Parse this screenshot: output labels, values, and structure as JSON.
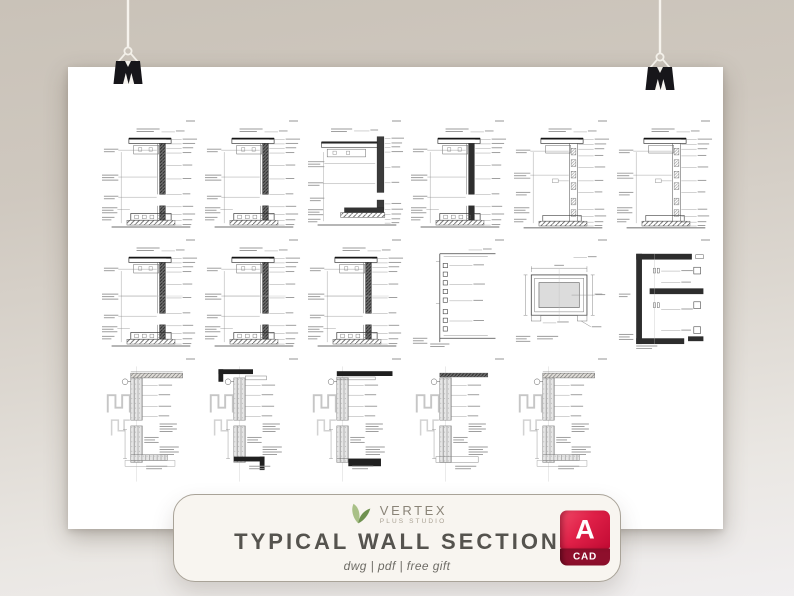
{
  "scene": {
    "background_top_color": "#c9c2b8",
    "background_bottom_color": "#f1eff0",
    "poster_color": "#ffffff",
    "clip_color": "#17161a",
    "string_color": "#f6f3ed"
  },
  "poster": {
    "description": "White sheet with 17 small CAD typical wall section detail drawings in three rows",
    "drawing_count": 17,
    "rows": [
      {
        "cells": [
          "ws1",
          "ws1",
          "ws2",
          "ws1-dark",
          "ws3",
          "ws3"
        ]
      },
      {
        "cells": [
          "ws1-mid",
          "ws1-mid",
          "ws1-mid",
          "tie",
          "frame",
          "jamb"
        ]
      },
      {
        "cells": [
          "par-a",
          "par-b",
          "par-c",
          "par-d",
          "par-a",
          "empty"
        ]
      }
    ]
  },
  "card": {
    "logo": {
      "brand": "VERTEX",
      "subtitle": "PLUS STUDIO",
      "leaf_light_color": "#a9c087",
      "leaf_dark_color": "#6f9150",
      "brand_color": "#8a8478"
    },
    "title": "TYPICAL WALL SECTION",
    "title_color": "#55534e",
    "subtitle": "dwg | pdf | free gift",
    "badge": {
      "letter": "A",
      "label": "CAD",
      "red_top_color": "#e02048",
      "red_dark_color": "#8e0f2c"
    }
  }
}
